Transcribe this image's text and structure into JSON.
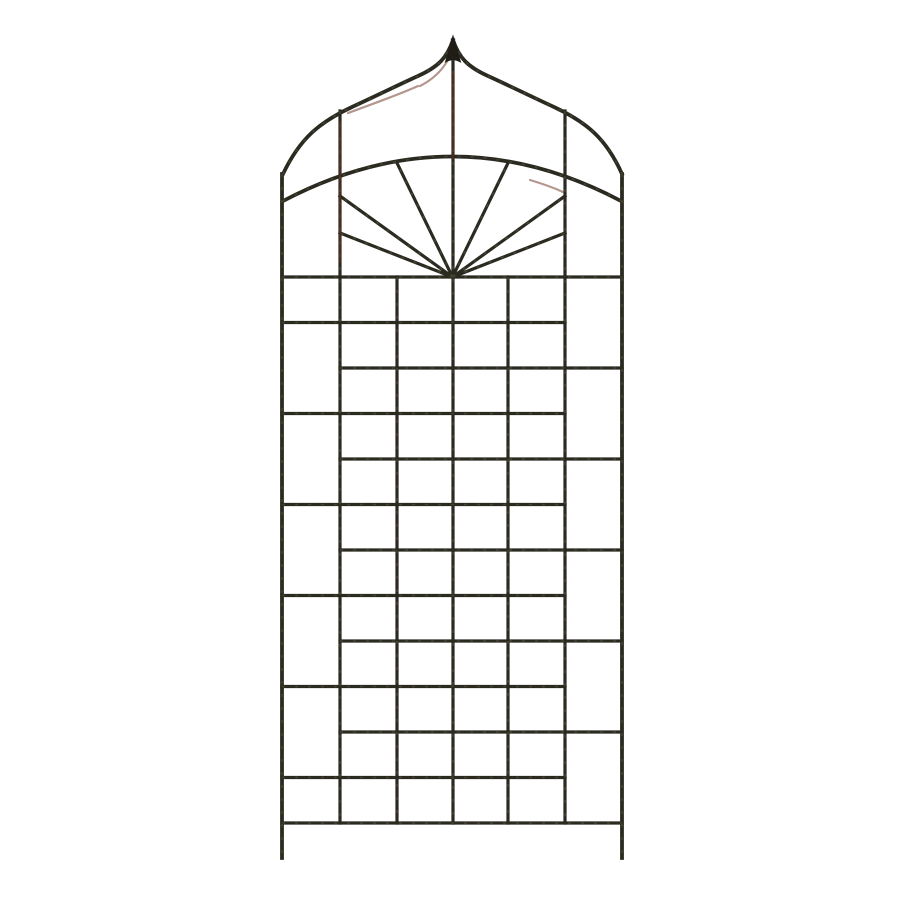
{
  "product_image": {
    "description": "Dark bronze wrought-iron garden trellis panel with pointed ogee arch top, finial spike, sunburst fan under an inner arch, staggered square lattice grid and two ground legs, photographed on a plain white background",
    "background_color": "#ffffff"
  },
  "trellis": {
    "colors": {
      "iron": "#2b2a21",
      "iron_dark": "#1f1d16",
      "patina": "#6e6848",
      "rust": "#69301f"
    },
    "stroke": {
      "frame_width": 3.8,
      "bar_width": 3.2,
      "patina_width": 1.6,
      "rust_width": 2.2,
      "patina_opacity": 0.38,
      "rust_opacity": 0.5,
      "patina_dash": "3 10"
    },
    "canvas": {
      "width": 900,
      "height": 900
    },
    "finial": {
      "path": "M 453 36 L 460.5 62 Q 453 57.5 445.5 62 Z"
    },
    "ogee": {
      "left_path": "M 453 40 C 447 58 438 67 418 76 C 398 85 374 97 352 107 C 320 122 300 138 283 174",
      "right_path": "M 453 40 C 459 58 468 67 488 76 C 508 85 532 97 554 107 C 586 122 606 138 622 174"
    },
    "arch": {
      "path": "M 283 201 Q 452.5 112 621 201"
    },
    "fan": {
      "center": [
        452.5,
        277
      ],
      "ray_ends": [
        [
          397,
          163
        ],
        [
          340,
          196
        ],
        [
          340,
          233
        ],
        [
          508,
          163
        ],
        [
          565,
          196
        ],
        [
          565,
          233
        ]
      ]
    },
    "verticals": [
      {
        "x": 282,
        "y1": 174,
        "y2": 858,
        "frame": true
      },
      {
        "x": 622,
        "y1": 174,
        "y2": 858,
        "frame": true
      },
      {
        "x": 340,
        "y1": 111,
        "y2": 823,
        "frame": false
      },
      {
        "x": 565,
        "y1": 111,
        "y2": 823,
        "frame": false
      },
      {
        "x": 397,
        "y1": 277,
        "y2": 823,
        "frame": false
      },
      {
        "x": 508,
        "y1": 277,
        "y2": 823,
        "frame": false
      },
      {
        "x": 453,
        "y1": 58,
        "y2": 823,
        "frame": false
      }
    ],
    "grid": {
      "row_ys": [
        277,
        322.5,
        368,
        413.5,
        459,
        504.5,
        550,
        595.5,
        641,
        686.5,
        732,
        777.5,
        823
      ],
      "full_span": [
        282,
        622
      ],
      "left_span": [
        282,
        565
      ],
      "right_span": [
        340,
        622
      ],
      "full_rows": [
        0,
        12
      ],
      "left_rows": [
        1,
        3,
        5,
        7,
        9,
        11
      ],
      "right_rows": [
        2,
        4,
        6,
        8,
        10
      ]
    },
    "rust_segments": [
      "M 448 60 C 441 72 432 80 420 86",
      "M 418 86 C 398 95 370 105 348 113",
      "M 340 122 L 340 262",
      "M 453 72 L 453 158",
      "M 530 180 Q 550 186 563 192"
    ]
  }
}
